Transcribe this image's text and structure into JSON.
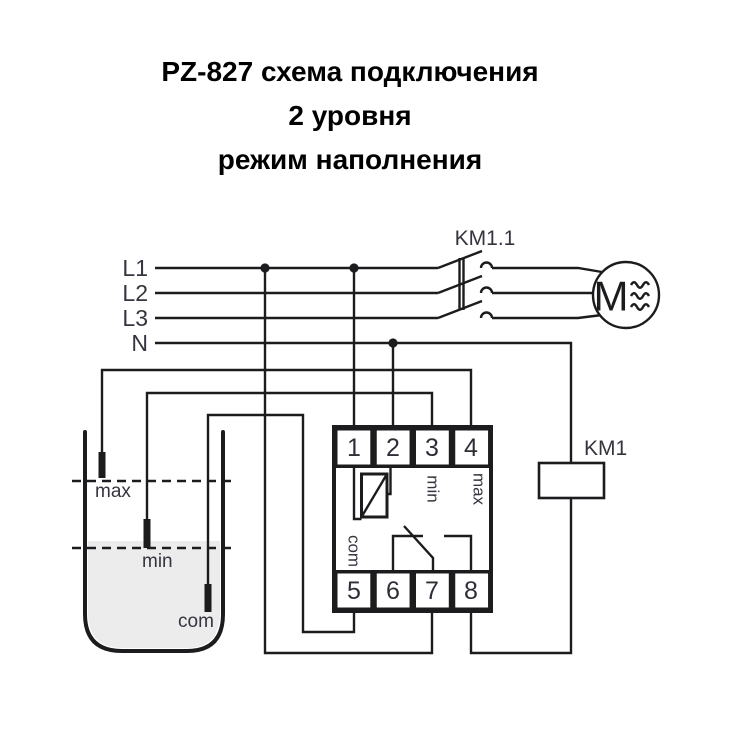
{
  "title": {
    "line1": "PZ-827 схема подключения",
    "line2": "2 уровня",
    "line3": "режим наполнения"
  },
  "power_labels": [
    "L1",
    "L2",
    "L3",
    "N"
  ],
  "contactor": {
    "contact_label": "KM1.1",
    "coil_label": "KM1"
  },
  "motor": {
    "letter": "M"
  },
  "relay": {
    "terminals_top": [
      "1",
      "2",
      "3",
      "4"
    ],
    "terminals_bottom": [
      "5",
      "6",
      "7",
      "8"
    ],
    "labels": {
      "min": "min",
      "max": "max",
      "com": "com"
    }
  },
  "tank": {
    "max_label": "max",
    "min_label": "min",
    "com_label": "com"
  },
  "colors": {
    "line": "#1c1c1f",
    "label_text": "#35353f",
    "title_text": "#000000",
    "liquid": "#ececec",
    "background": "#ffffff"
  }
}
